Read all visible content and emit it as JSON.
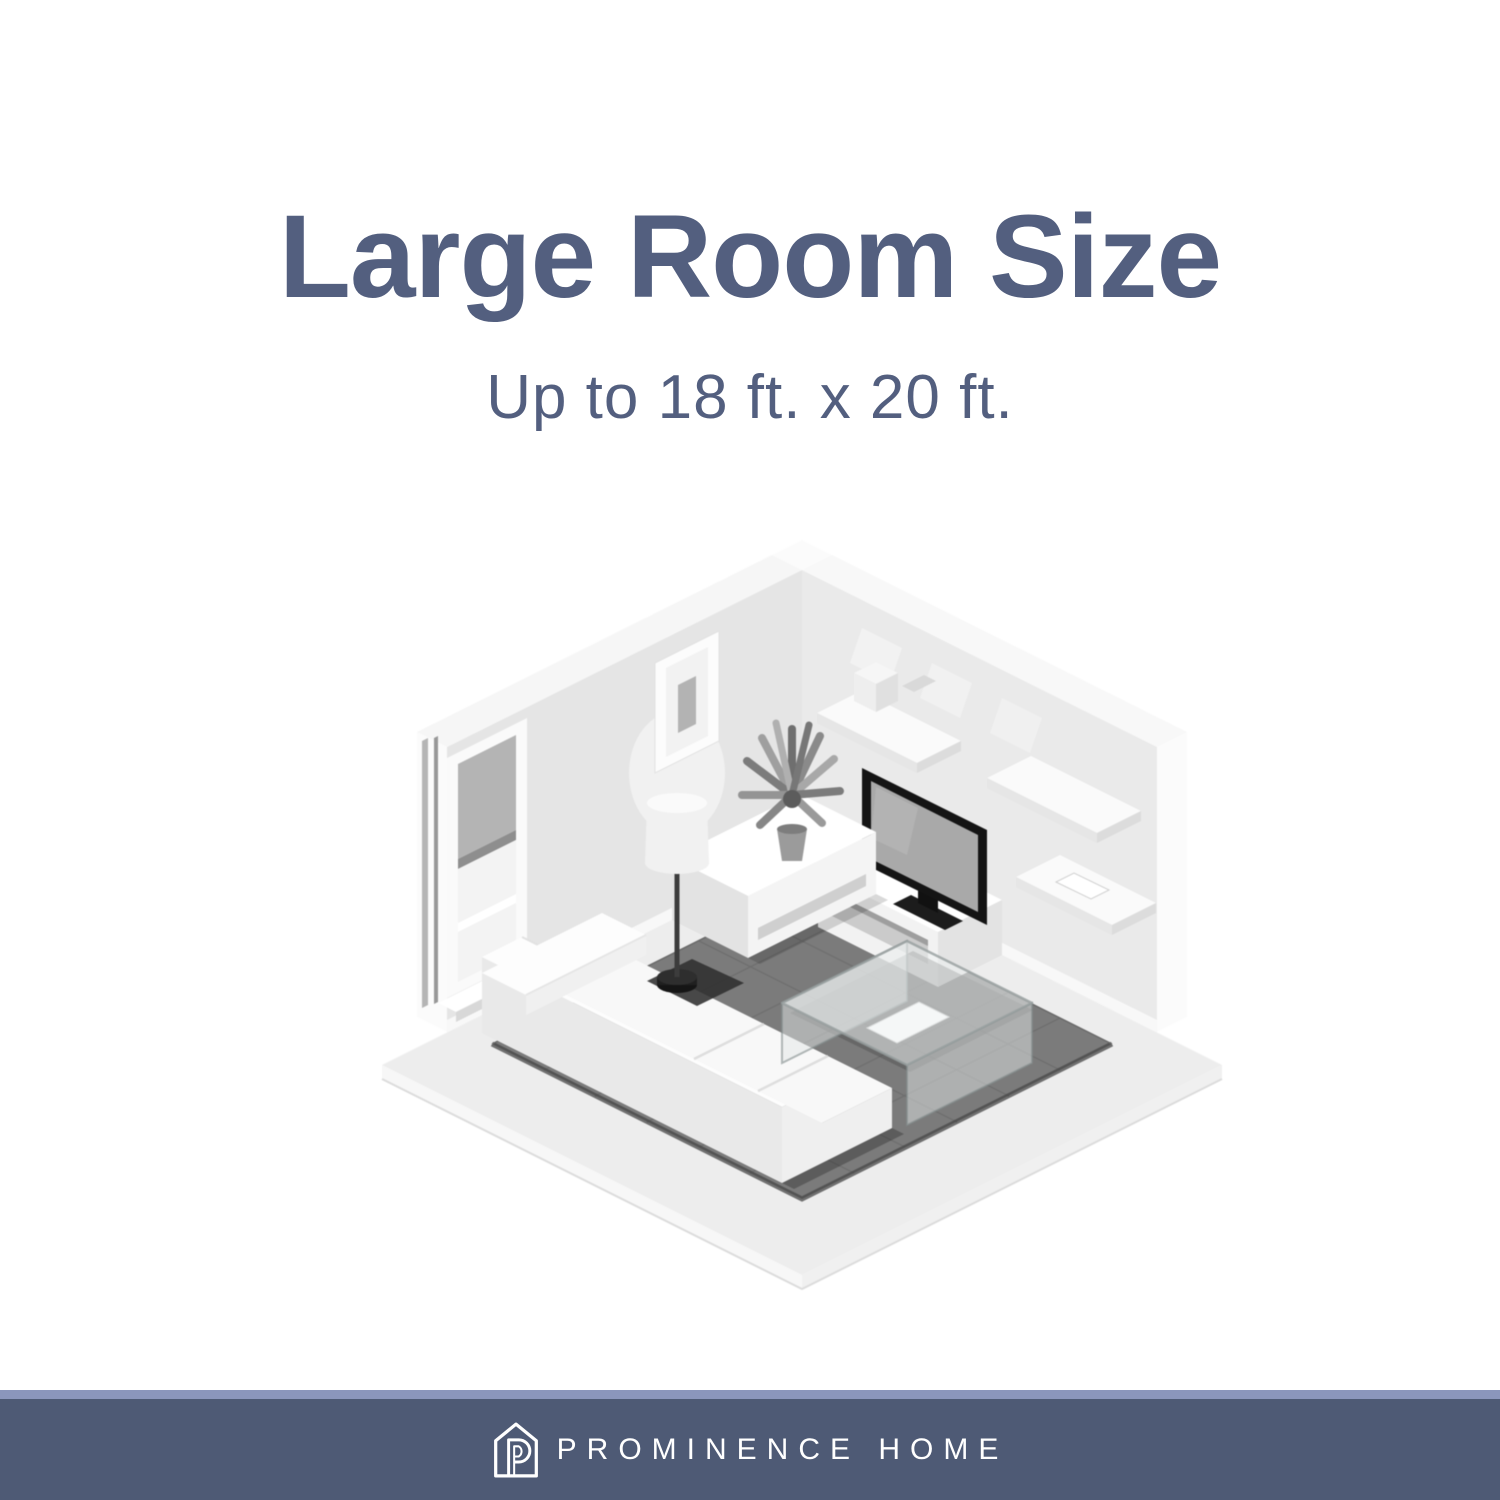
{
  "title": {
    "text": "Large Room Size"
  },
  "subtitle": {
    "text": "Up to 18 ft. x 20 ft."
  },
  "colors": {
    "ink": "#535f7f",
    "footer_bar": "#4e5a75",
    "footer_accent": "#8b96bc",
    "page_bg": "#ffffff"
  },
  "illustration": {
    "label": "isometric-living-room",
    "palette": {
      "wall": "#e7e7e7",
      "wall_trim": "#f8f8f8",
      "floor": "#ededed",
      "rug": "#7b7b7b",
      "rug_grid": "#6f6f6f",
      "furniture": "#f7f7f7",
      "tv_bezel": "#141414",
      "tv_screen": "#a9a9a9"
    },
    "objects": [
      "window-with-blinds",
      "framed-picture",
      "floor-lamp",
      "potted-plant",
      "sideboard",
      "sectional-sofa",
      "glass-coffee-table",
      "magazine",
      "flat-screen-tv",
      "tv-stand",
      "wall-shelf",
      "storage-box",
      "remote",
      "tile-rug",
      "baseboard"
    ]
  },
  "footer": {
    "brand": {
      "logo": "prominence-home-logo",
      "text": "PROMINENCE HOME"
    }
  }
}
